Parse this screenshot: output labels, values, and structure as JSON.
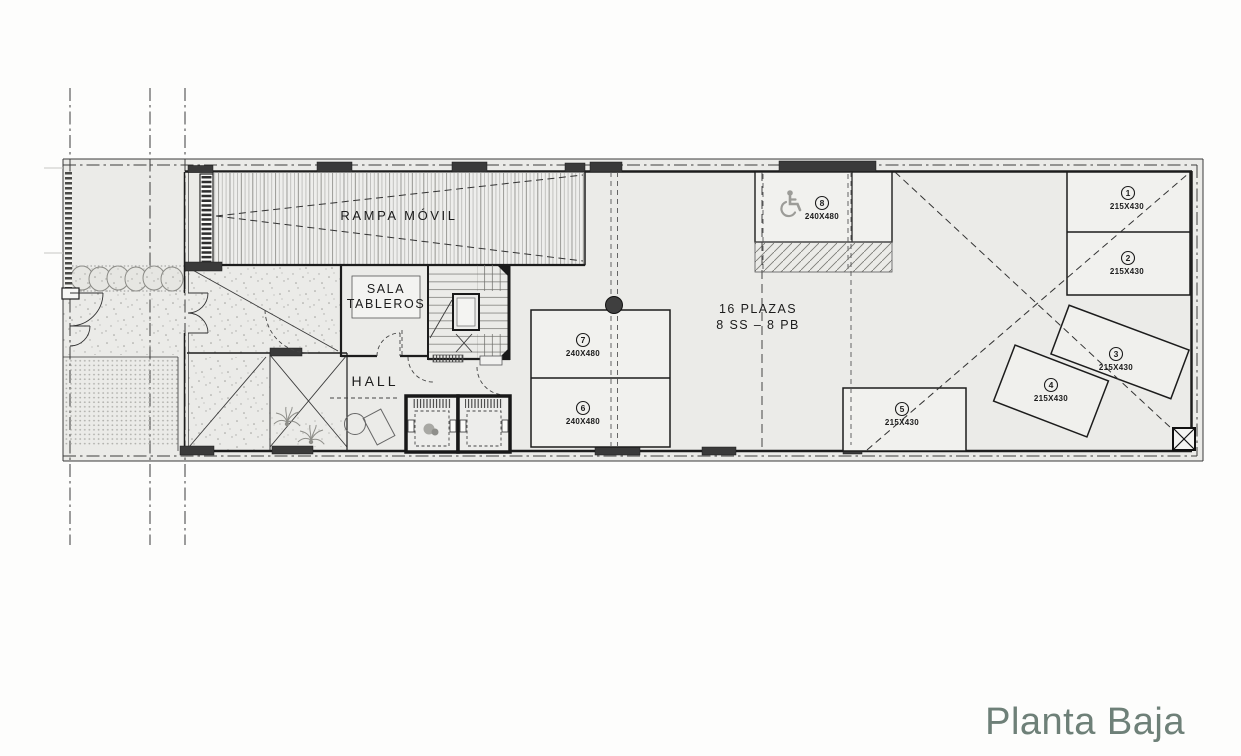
{
  "title": "Planta Baja",
  "colors": {
    "title": "#6e8078",
    "line": "#1c1c1c",
    "floor": "#ebebe8",
    "spot_fill": "#f1f1ee",
    "icon_gray": "#9c9c98"
  },
  "rooms": {
    "ramp": "RAMPA MÓVIL",
    "sala_line1": "SALA",
    "sala_line2": "TABLEROS",
    "hall": "HALL"
  },
  "parking_summary": {
    "line1": "16 PLAZAS",
    "line2": "8 SS – 8 PB"
  },
  "spots": [
    {
      "number": "1",
      "dims": "215X430"
    },
    {
      "number": "2",
      "dims": "215X430"
    },
    {
      "number": "3",
      "dims": "215X430"
    },
    {
      "number": "4",
      "dims": "215X430"
    },
    {
      "number": "5",
      "dims": "215X430"
    },
    {
      "number": "6",
      "dims": "240X480"
    },
    {
      "number": "7",
      "dims": "240X480"
    },
    {
      "number": "8",
      "dims": "240X480"
    }
  ],
  "icons": {
    "accessible": "wheelchair-icon",
    "column_marker": "x-box-marker"
  }
}
